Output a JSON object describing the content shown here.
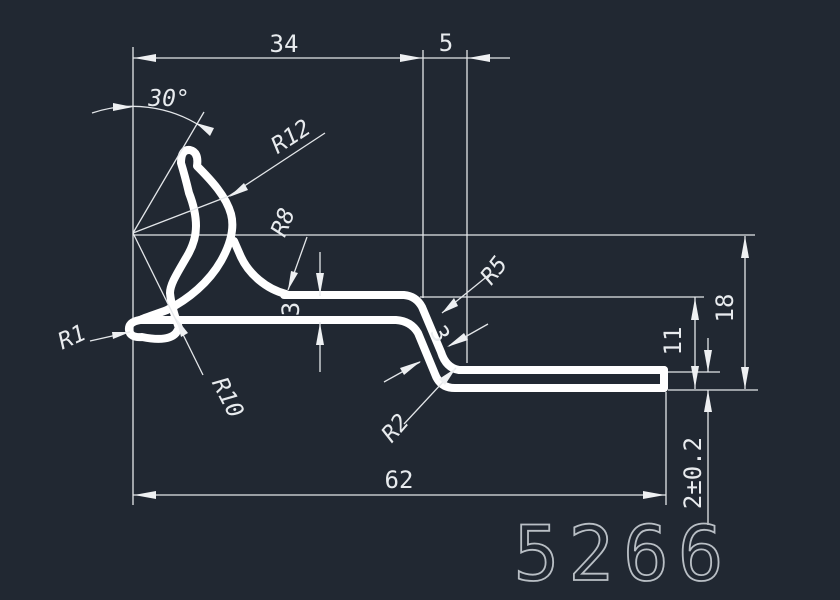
{
  "canvas": {
    "background_color": "#212832",
    "profile_line_color": "#ffffff",
    "dimension_line_color": "#e3e6e9",
    "part_number_color": "#b9bfc5"
  },
  "dimensions": {
    "top_width": "34",
    "top_offset": "5",
    "angle": "30°",
    "radius_outer_curl": "R12",
    "radius_bowl": "R8",
    "radius_bend_top": "R5",
    "radius_tip": "R1",
    "radius_inner_curl": "R10",
    "radius_bend_bottom": "R2",
    "web_thickness": "3",
    "bend_thickness": "3",
    "total_width": "62",
    "total_height": "18",
    "step_height": "11",
    "flange_thickness": "2±0.2"
  },
  "part_number": "5266"
}
